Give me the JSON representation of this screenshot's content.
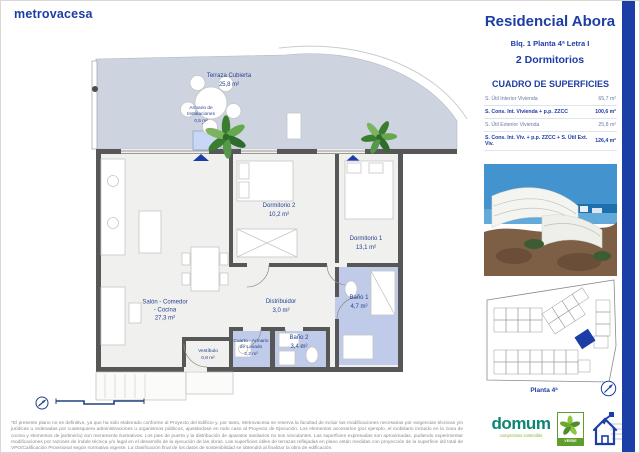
{
  "brand": {
    "logo_text": "metrovacesa"
  },
  "header": {
    "title": "Residencial Abora",
    "block_line": "Blq. 1 Planta 4ª Letra I",
    "bedrooms_line": "2 Dormitorios"
  },
  "surfaces_table": {
    "title": "CUADRO DE SUPERFICIES",
    "rows": [
      {
        "label": "S. Útil Interior Vivienda",
        "value": "65,7 m²"
      },
      {
        "label": "S. Cons. Int. Vivienda + p.p. ZZCC",
        "value": "100,6 m²"
      },
      {
        "label": "S. Útil Exterior Vivienda",
        "value": "25,8 m²"
      },
      {
        "label": "S. Cons. Int. Viv. + p.p. ZZCC + S. Útil Ext. Viv.",
        "value": "126,4 m²"
      }
    ]
  },
  "floor_plan": {
    "rooms": [
      {
        "name": "Terraza Cubierta",
        "area": "25,8 m²"
      },
      {
        "name": "Armario de Instalaciones",
        "area": "0,5 m²"
      },
      {
        "name": "Salón - Comedor - Cocina",
        "area": "27,3 m²"
      },
      {
        "name": "Dormitorio 2",
        "area": "10,2 m²"
      },
      {
        "name": "Dormitorio 1",
        "area": "13,1 m²"
      },
      {
        "name": "Distribuidor",
        "area": "3,0 m²"
      },
      {
        "name": "Baño 1",
        "area": "4,7 m²"
      },
      {
        "name": "Baño 2",
        "area": "3,4 m²"
      },
      {
        "name": "Cuarto - Armario de Lavado",
        "area": "2,2 m²"
      },
      {
        "name": "Vestíbulo",
        "area": "0,8 m²"
      }
    ]
  },
  "site_plan": {
    "caption": "Planta 4ª"
  },
  "footer": {
    "disclaimer": "*El presente plano no es definitivo, ya que ha sido elaborado conforme al Proyecto del Edificio y, por tanto, Metrovacesa se reserva la facultad de incluir las modificaciones necesarias por exigencias técnicas y/o jurídicas u ordenadas por cualesquiera administraciones u organismos públicos, ajustándose en todo caso al Proyecto de Ejecución. Los elementos accesorios (por ejemplo, el mobiliario incluido en la zona de cocina y elementos de jardinería) son meramente ilustrativos. Los pies de puerta y la distribución de aparatos sanitarios no son vinculantes. Las superficies expresadas son aproximadas, pudiendo experimentar modificaciones por razones de índole técnica y/o legal en el desarrollo de la ejecución de las obras. Las superficies útiles de terrazas reflejadas en plano están medidas con proyección de la superficie útil total de VPO/Calificación Provisional según normativa vigente. La clasificación final de los datos de sostenibilidad se obtendrá al finalizar la obra de edificación.",
    "domum_name": "domum",
    "domum_tagline": "compromiso sostenible",
    "verde_label": "VERDE"
  },
  "colors": {
    "brand_blue": "#1d3da6",
    "accent_bar": "#1b3fa6",
    "terrace_floor": "#cdd4e0",
    "wet_room_floor": "#bfcbe9",
    "wall": "#575757"
  }
}
